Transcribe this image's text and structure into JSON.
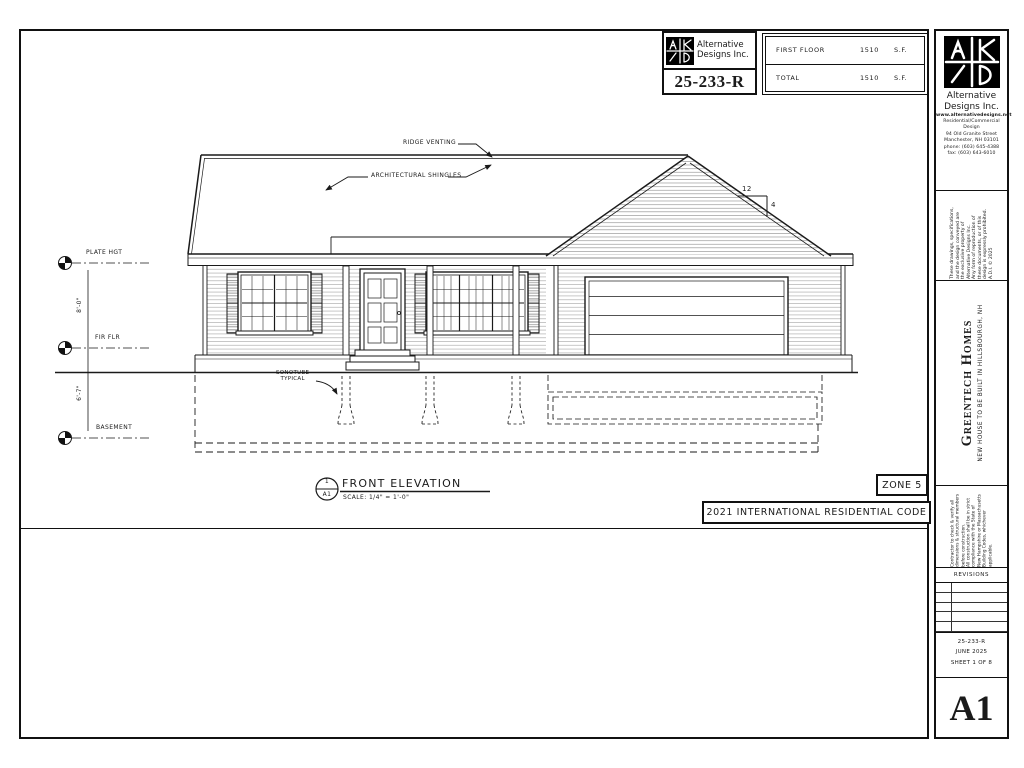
{
  "colors": {
    "ink": "#1a1a1a",
    "logo_bg": "#000000"
  },
  "title_block": {
    "firm_line1": "Alternative",
    "firm_line2": "Designs Inc.",
    "project_number": "25-233-R",
    "area_table": {
      "rows": [
        {
          "label": "FIRST FLOOR",
          "value": "1510",
          "unit": "S.F."
        },
        {
          "label": "TOTAL",
          "value": "1510",
          "unit": "S.F."
        }
      ]
    }
  },
  "sidebar": {
    "firm": {
      "name_line1": "Alternative",
      "name_line2": "Designs Inc.",
      "website": "www.alternativedesigns.net",
      "type_line1": "Residential/Commercial",
      "type_line2": "Design",
      "address_line1": "94 Old Granite Street",
      "address_line2": "Manchester, NH 03101",
      "phone": "phone: (603) 645-4388",
      "fax": "fax: (603) 643-6010"
    },
    "copyright": {
      "lines": [
        "These drawings, specifications,",
        "and the design conveyed are",
        "the exclusive property of",
        "Alternative Designs Inc.",
        "Any form of reproduction of",
        "these documents, or of this",
        "design is expressly prohibited.",
        "A.D.I. © 2025"
      ]
    },
    "project": {
      "client": "Greentech Homes",
      "description": "NEW HOUSE TO BE BUILT IN HILLSBOURGH, NH"
    },
    "contractor_note": {
      "lines": [
        "Contractor to check & verify all",
        "dimensions & structural members",
        "before construction.",
        "All construction shall be in strict",
        "compliance with the State of",
        "New Hampshire or Massachusetts",
        "Building Codes, whichever applicable."
      ]
    },
    "revisions_label": "REVISIONS",
    "project_number": "25-233-R",
    "date": "JUNE 2025",
    "sheet_label": "SHEET 1 OF 8",
    "sheet_id": "A1"
  },
  "drawing": {
    "callouts": {
      "ridge_venting": "RIDGE VENTING",
      "architectural_shingles": "ARCHITECTURAL SHINGLES",
      "sonotube": "SONOTUBE\nTYPICAL"
    },
    "datums": {
      "plate": "PLATE HGT",
      "first_floor": "FIR FLR",
      "basement": "BASEMENT"
    },
    "dimensions": {
      "plate_to_floor": "8'-0\"",
      "floor_to_basement": "6'-7\""
    },
    "roof_slope": {
      "run": "12",
      "rise": "4"
    },
    "title": {
      "detail_number": "1",
      "detail_sheet": "A1",
      "name": "FRONT ELEVATION",
      "scale": "SCALE: 1/4\" = 1'-0\""
    },
    "zone": "ZONE 5",
    "building_code": "2021 INTERNATIONAL RESIDENTIAL CODE"
  }
}
